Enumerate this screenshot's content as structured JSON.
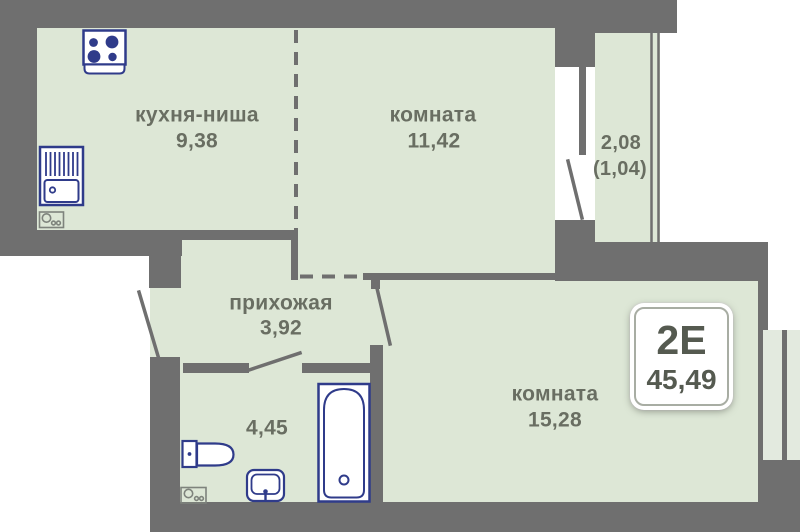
{
  "badge": {
    "plan_type": "2Е",
    "total_area": "45,49"
  },
  "rooms": {
    "kitchen": {
      "label": "кухня-ниша",
      "area": "9,38"
    },
    "living1": {
      "label": "комната",
      "area": "11,42"
    },
    "balcony": {
      "area_full": "2,08",
      "area_counted": "(1,04)"
    },
    "hallway": {
      "label": "прихожая",
      "area": "3,92"
    },
    "bathroom": {
      "area": "4,45"
    },
    "living2": {
      "label": "комната",
      "area": "15,28"
    }
  },
  "colors": {
    "wall": "#6f6f6f",
    "room_fill": "#dde7d6",
    "window_fill": "#e3eadf",
    "fixture_blue": "#2f3b8a",
    "label_text": "#696e62",
    "badge_text": "#555a50"
  },
  "icons": {
    "stove": "stove-icon",
    "kitchen_sink": "kitchen-sink-icon",
    "washer_place": "washer-icon",
    "toilet": "toilet-icon",
    "washbasin": "washbasin-icon",
    "bathtub": "bathtub-icon",
    "doors": "door-swing",
    "balcony_window": "balcony-glazing-window",
    "room_window": "window"
  }
}
